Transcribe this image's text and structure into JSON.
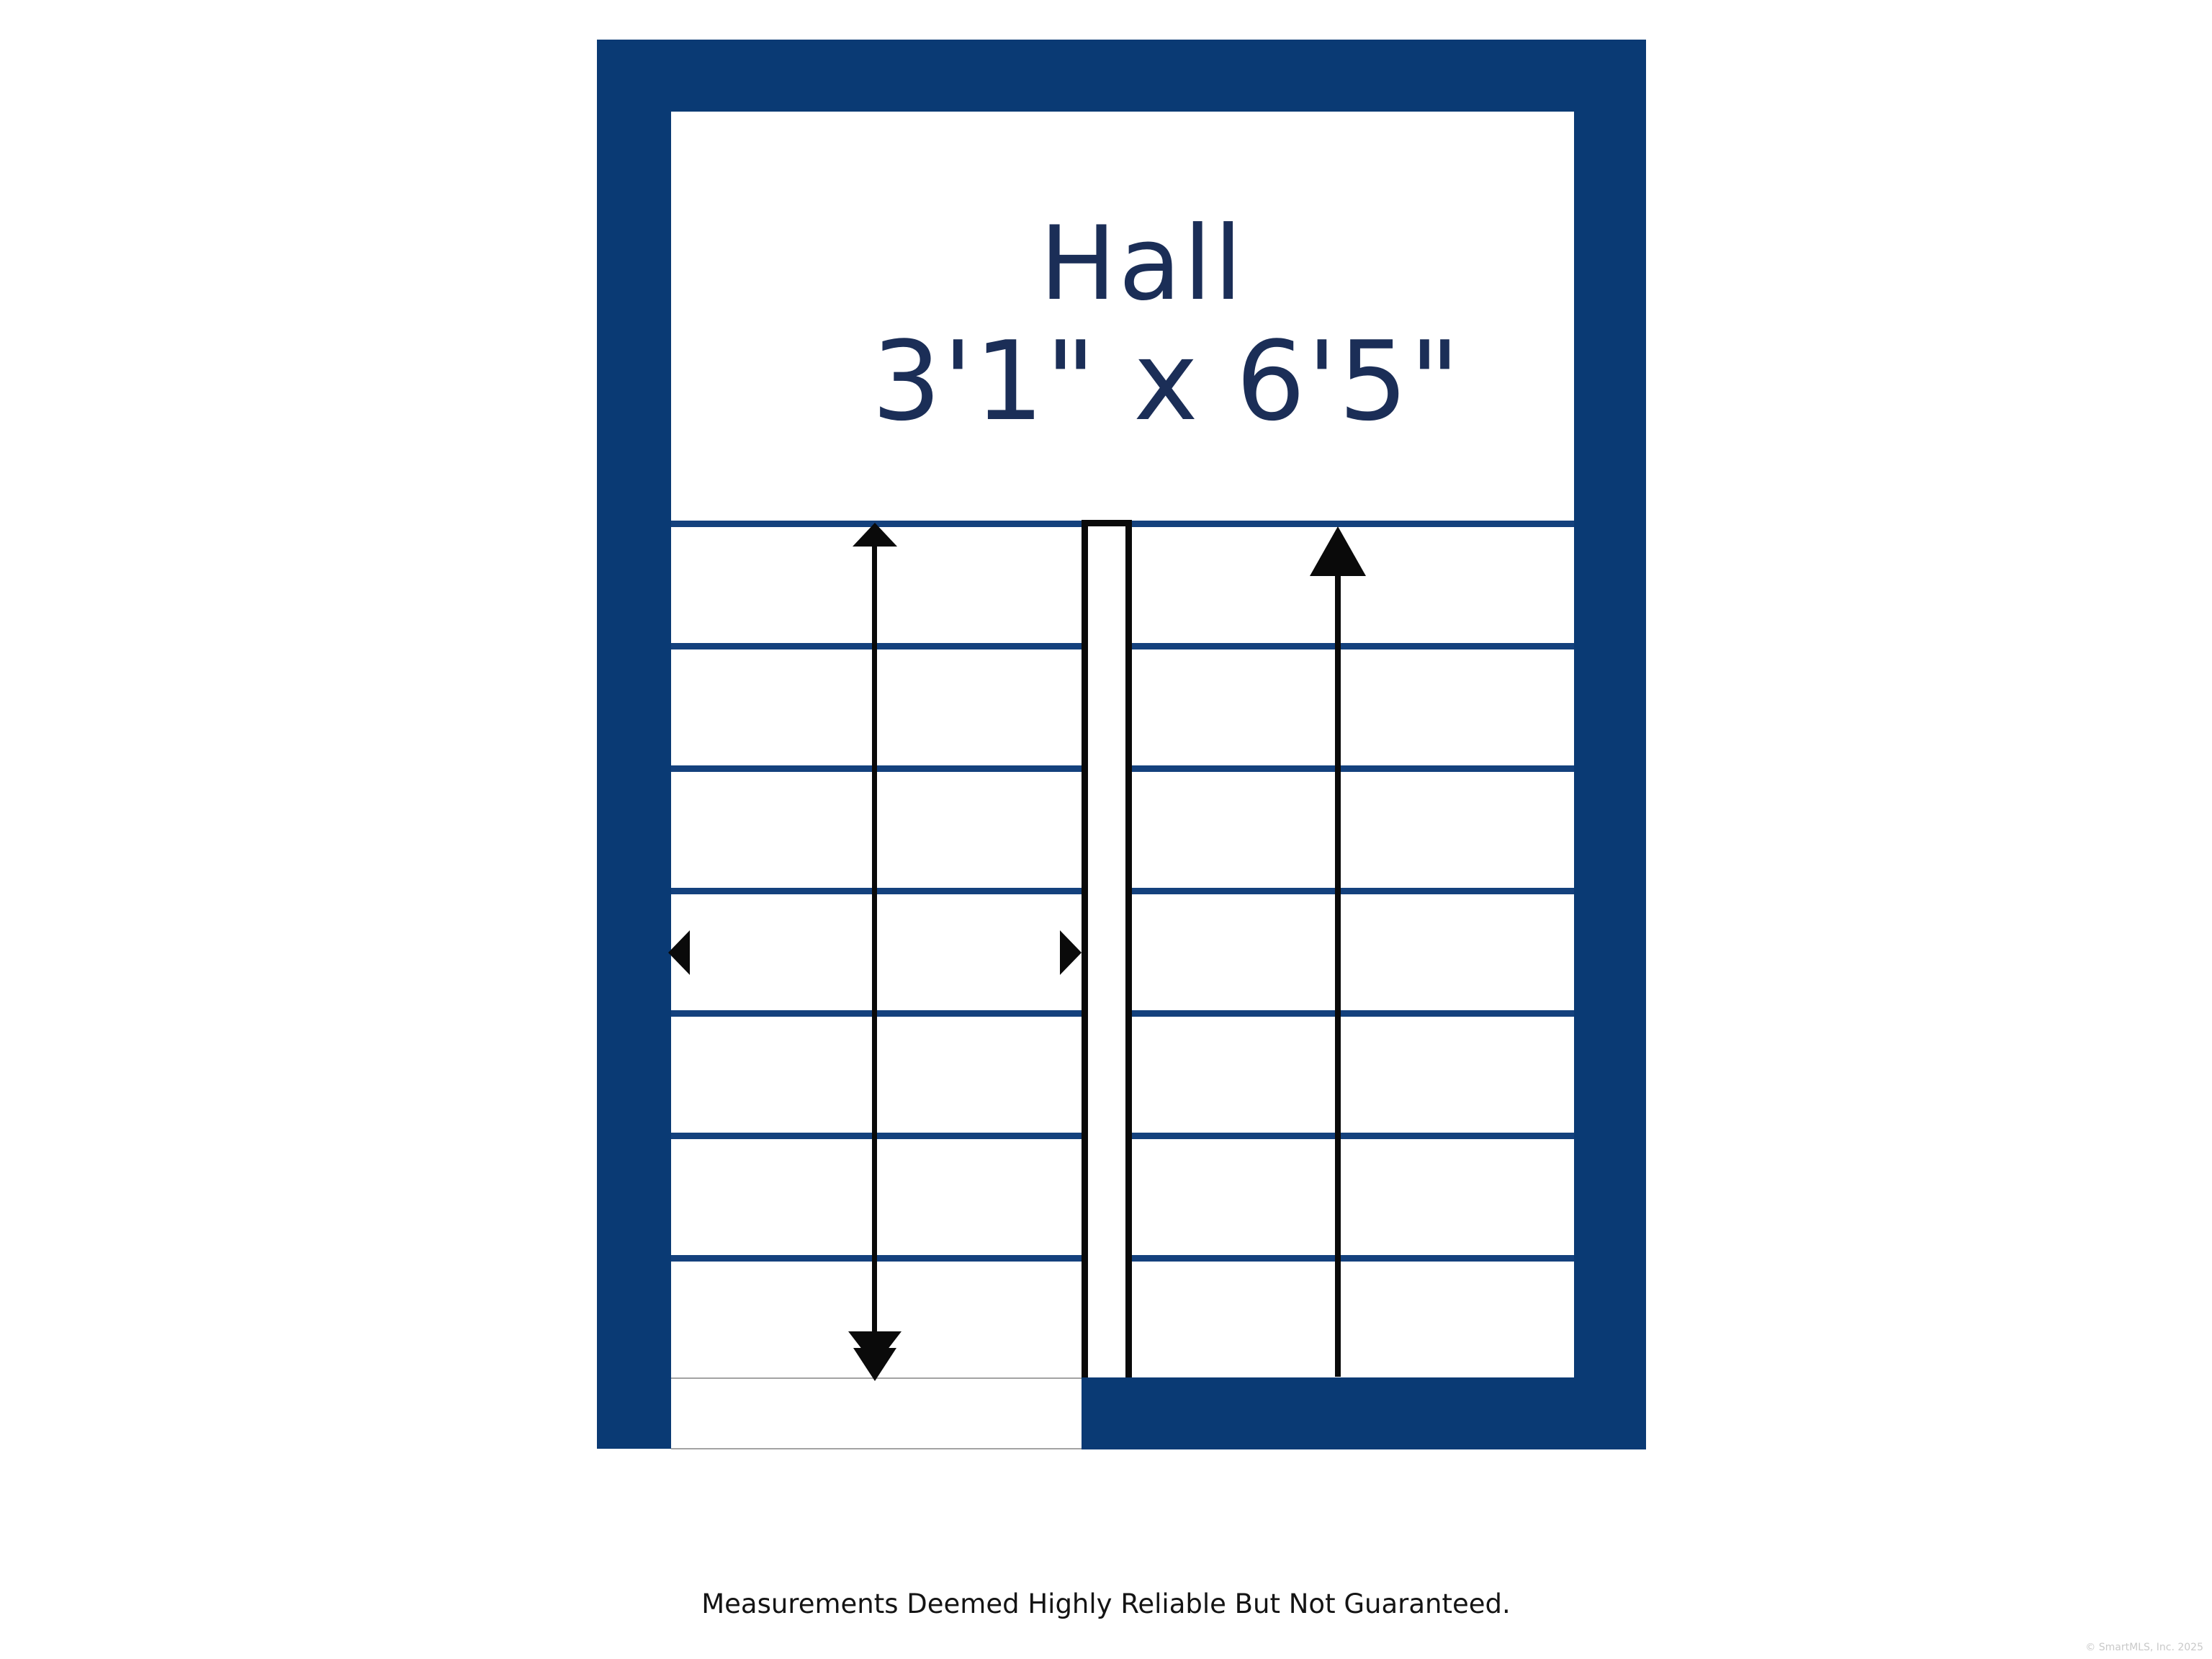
{
  "floorplan": {
    "room": {
      "name": "Hall",
      "dimensions": "3'1\" x 6'5\""
    },
    "stairs": {
      "left_flight_steps": 7,
      "right_flight_steps": 7,
      "left_flight_arrow": "double-headed up-down arrow",
      "right_flight_arrow": "up arrow",
      "mid_markers": "left and right facing triangles"
    },
    "colors": {
      "wall": "#0a3a74",
      "tread_line": "#14417d",
      "room_label": "#1b2e57",
      "arrow": "#0a0a0a",
      "landing_edge": "#a3a3a3"
    }
  },
  "footer": {
    "disclaimer": "Measurements Deemed Highly Reliable But Not Guaranteed.",
    "copyright": "© SmartMLS, Inc. 2025"
  }
}
